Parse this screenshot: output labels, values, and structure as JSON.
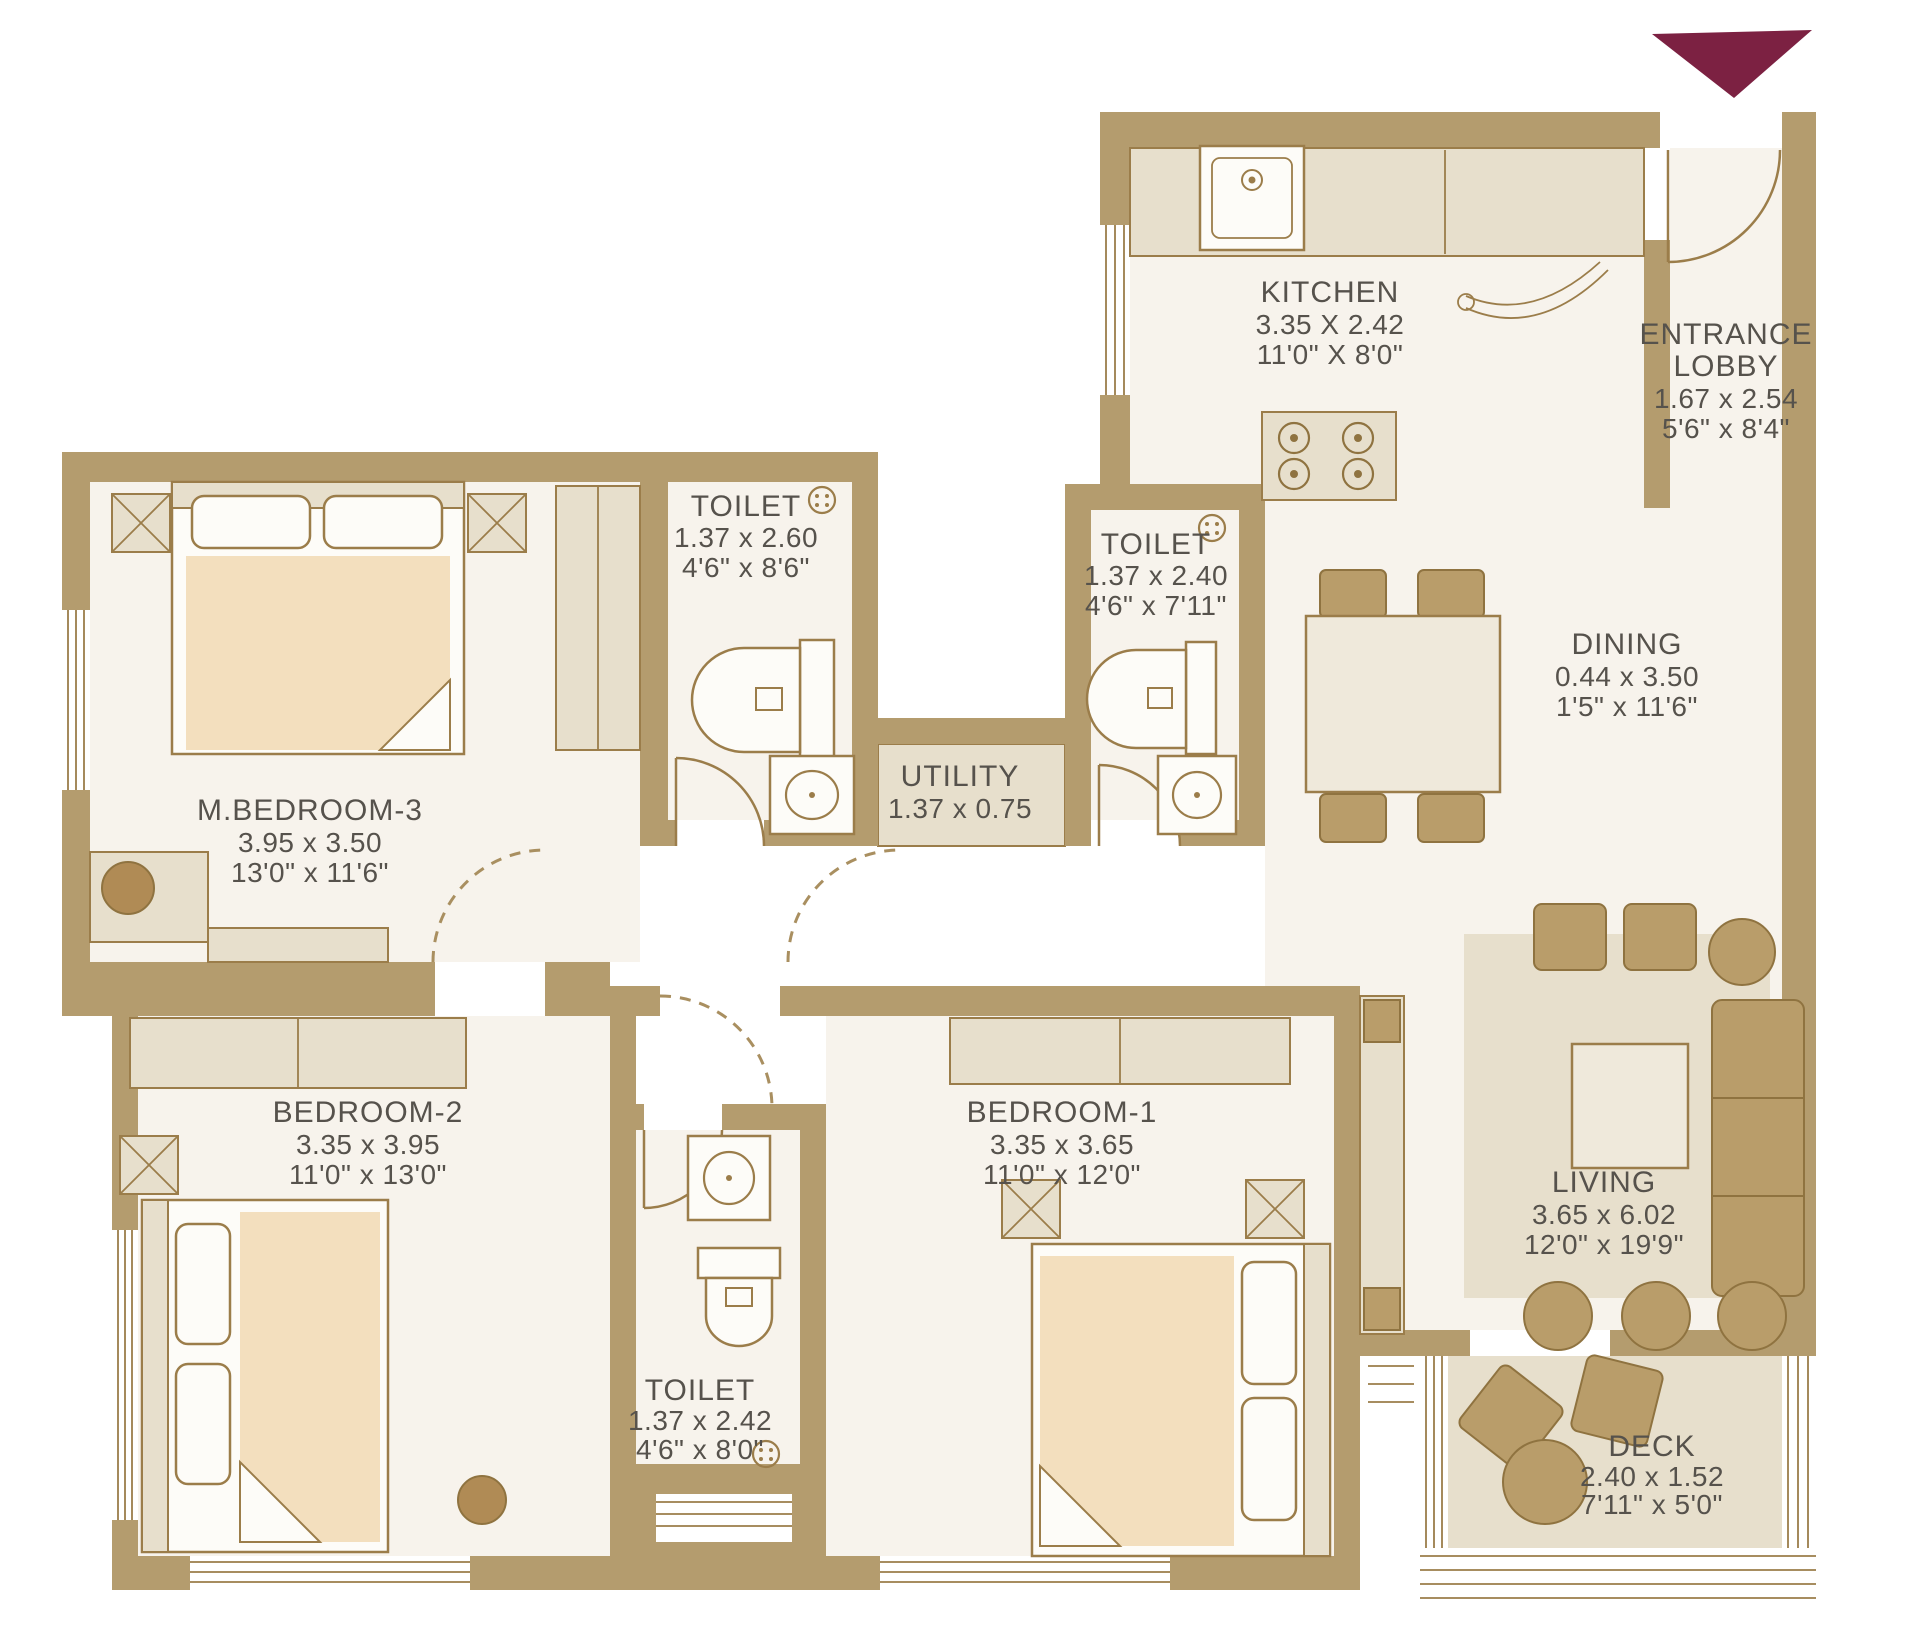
{
  "colors": {
    "wall": "#b49c6e",
    "floor": "#f7f3ec",
    "furniture_beige": "#e7dfcc",
    "bed_peach": "#f3dfbe",
    "accent_tan": "#b99d6a",
    "text": "#56524c",
    "arrow": "#7c2142"
  },
  "rooms": {
    "kitchen": {
      "name": "KITCHEN",
      "metric": "3.35 X 2.42",
      "imperial": "11'0\" X 8'0\""
    },
    "entrance_lobby": {
      "name_line1": "ENTRANCE",
      "name_line2": "LOBBY",
      "metric": "1.67 x 2.54",
      "imperial": "5'6\" x 8'4\""
    },
    "toilet_master": {
      "name": "TOILET",
      "metric": "1.37 x 2.60",
      "imperial": "4'6\" x 8'6\""
    },
    "toilet_common": {
      "name": "TOILET",
      "metric": "1.37 x 2.40",
      "imperial": "4'6\" x 7'11\""
    },
    "utility": {
      "name": "UTILITY",
      "metric": "1.37 x 0.75"
    },
    "dining": {
      "name": "DINING",
      "metric": "0.44 x 3.50",
      "imperial": "1'5\" x 11'6\""
    },
    "master_bedroom_3": {
      "name": "M.BEDROOM-3",
      "metric": "3.95 x 3.50",
      "imperial": "13'0\" x 11'6\""
    },
    "bedroom_2": {
      "name": "BEDROOM-2",
      "metric": "3.35 x 3.95",
      "imperial": "11'0\" x 13'0\""
    },
    "bedroom_1": {
      "name": "BEDROOM-1",
      "metric": "3.35 x 3.65",
      "imperial": "11'0\" x 12'0\""
    },
    "toilet_bedroom1": {
      "name": "TOILET",
      "metric": "1.37 x 2.42",
      "imperial": "4'6\" x 8'0\""
    },
    "living": {
      "name": "LIVING",
      "metric": "3.65 x 6.02",
      "imperial": "12'0\" x 19'9\""
    },
    "deck": {
      "name": "DECK",
      "metric": "2.40 x 1.52",
      "imperial": "7'11\" x 5'0\""
    }
  }
}
